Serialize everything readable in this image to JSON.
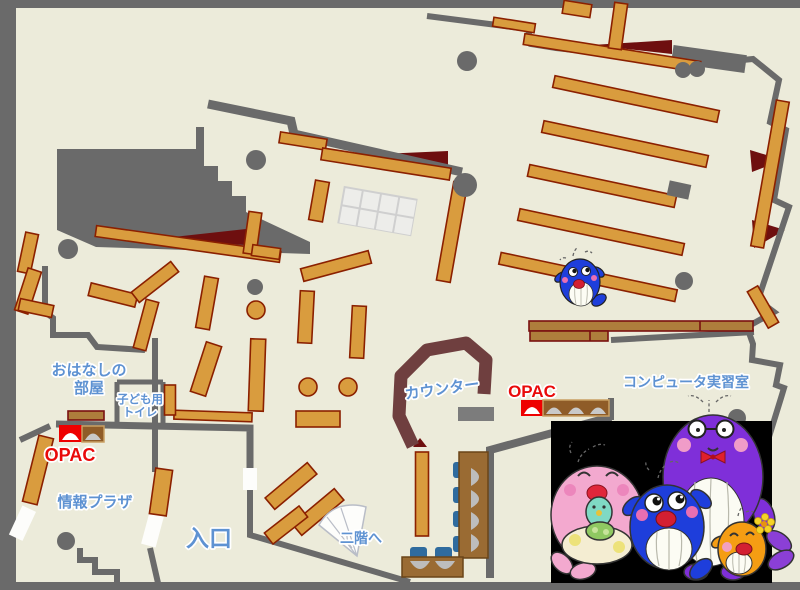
{
  "labels": {
    "storytelling_room_line1": "おはなしの",
    "storytelling_room_line2": "部屋",
    "kids_toilet_line1": "子ども用",
    "kids_toilet_line2": "トイレ",
    "opac_left": "OPAC",
    "info_plaza": "情報プラザ",
    "entrance": "入口",
    "to_second_floor": "二階へ",
    "counter": "カウンター",
    "opac_right": "OPAC",
    "computer_room": "コンピュータ実習室"
  },
  "colors": {
    "floor": "#ECEBDA",
    "wall_gray": "#6A6A6A",
    "shelf_orange": "#D99C3E",
    "shelf_border": "#8B2000",
    "table_brown": "#9A6B33",
    "accent_maroon": "#6E0F0F",
    "counter_maroon": "#6F3F3F",
    "label_blue": "#5E92D2",
    "opac_red": "#E90A0A",
    "chair_blue": "#2F6B9E",
    "photo_background": "#000000"
  },
  "mascots": {
    "photo_panel": [
      "pink-whale",
      "blue-whale",
      "purple-whale",
      "orange-fish",
      "baby-whale"
    ],
    "on_map": "small-blue-whale"
  }
}
